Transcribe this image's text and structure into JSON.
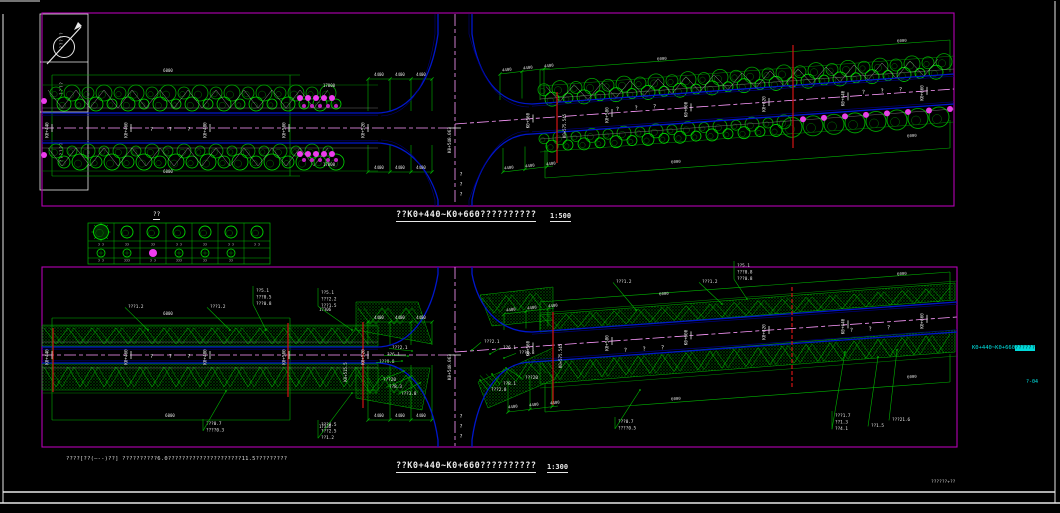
{
  "colors": {
    "frame": "#b400b4",
    "dim": "#00b400",
    "tree": "#00a800",
    "tree2": "#00d800",
    "boundary": "#008800",
    "blue": "#0017cc",
    "blue2": "#00007f",
    "center": "#ff9bff",
    "red": "#c41212",
    "white": "#e8e8e8",
    "cyan": "#00e5e5",
    "magenta": "#ee3cee",
    "hatchdot": "#009e00"
  },
  "titles": {
    "legend_title": "??",
    "top_plan_text": "??K0+440~K0+660??????????",
    "top_plan_scale": "1:500",
    "bottom_plan_text": "??K0+440~K0+660??????????",
    "bottom_plan_scale": "1:300",
    "note": "????[??(—--)??]  ??????????6.0?????????????????????11.5?????????",
    "side_station_text": "K0+440~K0+660",
    "side_station_highlight": "??????",
    "sheet_no": "?-04",
    "org_small": "??????+??"
  },
  "titleblock_cells": [
    "?????",
    "????",
    "??????"
  ],
  "legend": {
    "row1_labels": [
      "? ?",
      "??",
      "??",
      "? ?",
      "??",
      "? ?",
      "? ?"
    ],
    "row2_labels": [
      "? ?",
      "???",
      "? ?",
      "???",
      "??",
      "??"
    ]
  },
  "top_plan": {
    "road_name": "? ? ?",
    "center_station": "K0+540.063",
    "vertical_road_name": "???",
    "stations": [
      {
        "label": "K0+440",
        "x": 52
      },
      {
        "label": "K0+460",
        "x": 131
      },
      {
        "label": "K0+480",
        "x": 210
      },
      {
        "label": "K0+500",
        "x": 289
      },
      {
        "label": "K0+520",
        "x": 368
      },
      {
        "label": "K0+560",
        "x": 533
      },
      {
        "label": "K0+580",
        "x": 612
      },
      {
        "label": "K0+600",
        "x": 691
      },
      {
        "label": "K0+620",
        "x": 769
      },
      {
        "label": "K0+640",
        "x": 848
      },
      {
        "label": "K0+660",
        "x": 927
      }
    ],
    "road_names": [
      {
        "x": 150,
        "y": 131,
        "r": 0
      },
      {
        "x": 616,
        "y": 111,
        "r": -4
      },
      {
        "x": 862,
        "y": 94,
        "r": -4
      }
    ],
    "culverts": [
      {
        "x": 557,
        "y1": 92,
        "y2": 163,
        "label": "K0+575.545",
        "lx": 566,
        "ly": 126
      },
      {
        "x": 793,
        "y1": 45,
        "y2": 148,
        "label": ""
      }
    ],
    "dims": [
      {
        "t": "6000",
        "x": 168,
        "y": 72
      },
      {
        "t": "6000",
        "x": 168,
        "y": 173
      },
      {
        "t": "17000",
        "x": 329,
        "y": 87
      },
      {
        "t": "17000",
        "x": 329,
        "y": 166
      },
      {
        "t": "4400",
        "x": 379,
        "y": 76
      },
      {
        "t": "4400",
        "x": 400,
        "y": 76
      },
      {
        "t": "4400",
        "x": 421,
        "y": 76
      },
      {
        "t": "4400",
        "x": 379,
        "y": 169
      },
      {
        "t": "4400",
        "x": 400,
        "y": 169
      },
      {
        "t": "4400",
        "x": 421,
        "y": 169
      },
      {
        "t": "4400",
        "x": 507,
        "y": 71,
        "r": -6
      },
      {
        "t": "4400",
        "x": 528,
        "y": 69,
        "r": -6
      },
      {
        "t": "4400",
        "x": 549,
        "y": 67,
        "r": -6
      },
      {
        "t": "4400",
        "x": 509,
        "y": 169,
        "r": -6
      },
      {
        "t": "4400",
        "x": 530,
        "y": 167,
        "r": -6
      },
      {
        "t": "4400",
        "x": 551,
        "y": 165,
        "r": -6
      },
      {
        "t": "6000",
        "x": 662,
        "y": 60,
        "r": -4
      },
      {
        "t": "6000",
        "x": 902,
        "y": 42,
        "r": -4
      },
      {
        "t": "6000",
        "x": 676,
        "y": 163,
        "r": -4
      },
      {
        "t": "6000",
        "x": 912,
        "y": 137,
        "r": -4
      }
    ]
  },
  "bottom_plan": {
    "road_name": "? ? ?",
    "center_station": "K0+540.063",
    "vertical_road_name": "???",
    "stations": [
      {
        "label": "K0+440",
        "x": 52
      },
      {
        "label": "K0+460",
        "x": 131
      },
      {
        "label": "K0+480",
        "x": 210
      },
      {
        "label": "K0+500",
        "x": 289
      },
      {
        "label": "K0+520",
        "x": 368
      },
      {
        "label": "K0+560",
        "x": 533
      },
      {
        "label": "K0+580",
        "x": 612
      },
      {
        "label": "K0+600",
        "x": 691
      },
      {
        "label": "K0+620",
        "x": 769
      },
      {
        "label": "K0+640",
        "x": 848
      },
      {
        "label": "K0+660",
        "x": 927
      }
    ],
    "road_names": [
      {
        "x": 150,
        "y": 358,
        "r": 0
      },
      {
        "x": 624,
        "y": 352,
        "r": -4
      },
      {
        "x": 850,
        "y": 332,
        "r": -4
      }
    ],
    "culverts": [
      {
        "x": 53,
        "y1": 328,
        "y2": 392,
        "label": ""
      },
      {
        "x": 288,
        "y1": 323,
        "y2": 397,
        "label": ""
      },
      {
        "x": 363,
        "y1": 322,
        "y2": 408,
        "label": "K0+515.5",
        "lx": 347,
        "ly": 372
      },
      {
        "x": 553,
        "y1": 312,
        "y2": 405,
        "label": "K0+575.545",
        "lx": 562,
        "ly": 356
      },
      {
        "x": 792,
        "y1": 287,
        "y2": 387,
        "label": "",
        "dashed": true
      }
    ],
    "dims": [
      {
        "t": "6000",
        "x": 168,
        "y": 315
      },
      {
        "t": "6000",
        "x": 170,
        "y": 417
      },
      {
        "t": "17306",
        "x": 325,
        "y": 311
      },
      {
        "t": "17336",
        "x": 325,
        "y": 428
      },
      {
        "t": "4400",
        "x": 379,
        "y": 319
      },
      {
        "t": "4400",
        "x": 400,
        "y": 319
      },
      {
        "t": "4400",
        "x": 421,
        "y": 319
      },
      {
        "t": "4400",
        "x": 379,
        "y": 417
      },
      {
        "t": "4400",
        "x": 400,
        "y": 417
      },
      {
        "t": "4400",
        "x": 421,
        "y": 417
      },
      {
        "t": "4400",
        "x": 511,
        "y": 311,
        "r": -6
      },
      {
        "t": "4400",
        "x": 532,
        "y": 309,
        "r": -6
      },
      {
        "t": "4400",
        "x": 553,
        "y": 307,
        "r": -6
      },
      {
        "t": "4400",
        "x": 513,
        "y": 408,
        "r": -6
      },
      {
        "t": "4400",
        "x": 534,
        "y": 406,
        "r": -6
      },
      {
        "t": "4400",
        "x": 555,
        "y": 404,
        "r": -6
      },
      {
        "t": "6000",
        "x": 664,
        "y": 295,
        "r": -4
      },
      {
        "t": "6000",
        "x": 902,
        "y": 275,
        "r": -4
      },
      {
        "t": "6000",
        "x": 676,
        "y": 400,
        "r": -4
      },
      {
        "t": "6000",
        "x": 912,
        "y": 378,
        "r": -4
      }
    ],
    "callouts": [
      {
        "lines": [
          "???1.2"
        ],
        "x": 128,
        "y": 304,
        "px": 148,
        "py": 330
      },
      {
        "lines": [
          "???1.2"
        ],
        "x": 210,
        "y": 304,
        "px": 230,
        "py": 330
      },
      {
        "lines": [
          "??5.1",
          "???0.5",
          "???0.8"
        ],
        "x": 256,
        "y": 288,
        "px": 266,
        "py": 330
      },
      {
        "lines": [
          "???0.7",
          "????0.3"
        ],
        "x": 206,
        "y": 421,
        "px": 226,
        "py": 391
      },
      {
        "lines": [
          "??5.1",
          "???2.2",
          "???1.5"
        ],
        "x": 321,
        "y": 290,
        "px": 352,
        "py": 330
      },
      {
        "lines": [
          "???0.5",
          "???2.5",
          "??1.2"
        ],
        "x": 321,
        "y": 422,
        "px": 352,
        "py": 393
      },
      {
        "lines": [
          "???2.1"
        ],
        "x": 392,
        "y": 345,
        "px": 412,
        "py": 351
      },
      {
        "lines": [
          "??6.1"
        ],
        "x": 387,
        "y": 352,
        "px": 408,
        "py": 356
      },
      {
        "lines": [
          "???9.8"
        ],
        "x": 379,
        "y": 359,
        "px": 402,
        "py": 361
      },
      {
        "lines": [
          "???20"
        ],
        "x": 383,
        "y": 377,
        "px": 404,
        "py": 371
      },
      {
        "lines": [
          "??8.3"
        ],
        "x": 389,
        "y": 384,
        "px": 410,
        "py": 377
      },
      {
        "lines": [
          "???3.8"
        ],
        "x": 401,
        "y": 391,
        "px": 420,
        "py": 383
      },
      {
        "lines": [
          "???2.1"
        ],
        "x": 484,
        "y": 339,
        "px": 472,
        "py": 350
      },
      {
        "lines": [
          "??6.1"
        ],
        "x": 503,
        "y": 345,
        "px": 490,
        "py": 354
      },
      {
        "lines": [
          "???0.8"
        ],
        "x": 519,
        "y": 350,
        "px": 504,
        "py": 358
      },
      {
        "lines": [
          "???20"
        ],
        "x": 525,
        "y": 375,
        "px": 506,
        "py": 368
      },
      {
        "lines": [
          "??8.1"
        ],
        "x": 503,
        "y": 381,
        "px": 492,
        "py": 374
      },
      {
        "lines": [
          "???2.8"
        ],
        "x": 491,
        "y": 387,
        "px": 480,
        "py": 380
      },
      {
        "lines": [
          "???1.2"
        ],
        "x": 616,
        "y": 279,
        "px": 636,
        "py": 310
      },
      {
        "lines": [
          "???1.2"
        ],
        "x": 702,
        "y": 279,
        "px": 722,
        "py": 304
      },
      {
        "lines": [
          "??5.1",
          "???0.8",
          "???0.8"
        ],
        "x": 737,
        "y": 263,
        "px": 747,
        "py": 299
      },
      {
        "lines": [
          "???0.7",
          "????0.5"
        ],
        "x": 618,
        "y": 419,
        "px": 640,
        "py": 390
      },
      {
        "lines": [
          "???1.7",
          "??1.3",
          "??4.1"
        ],
        "x": 835,
        "y": 413,
        "px": 845,
        "py": 352
      },
      {
        "lines": [
          "??1.5"
        ],
        "x": 871,
        "y": 423,
        "px": 878,
        "py": 357
      },
      {
        "lines": [
          "???21.6"
        ],
        "x": 892,
        "y": 417,
        "px": 897,
        "py": 350
      }
    ]
  }
}
